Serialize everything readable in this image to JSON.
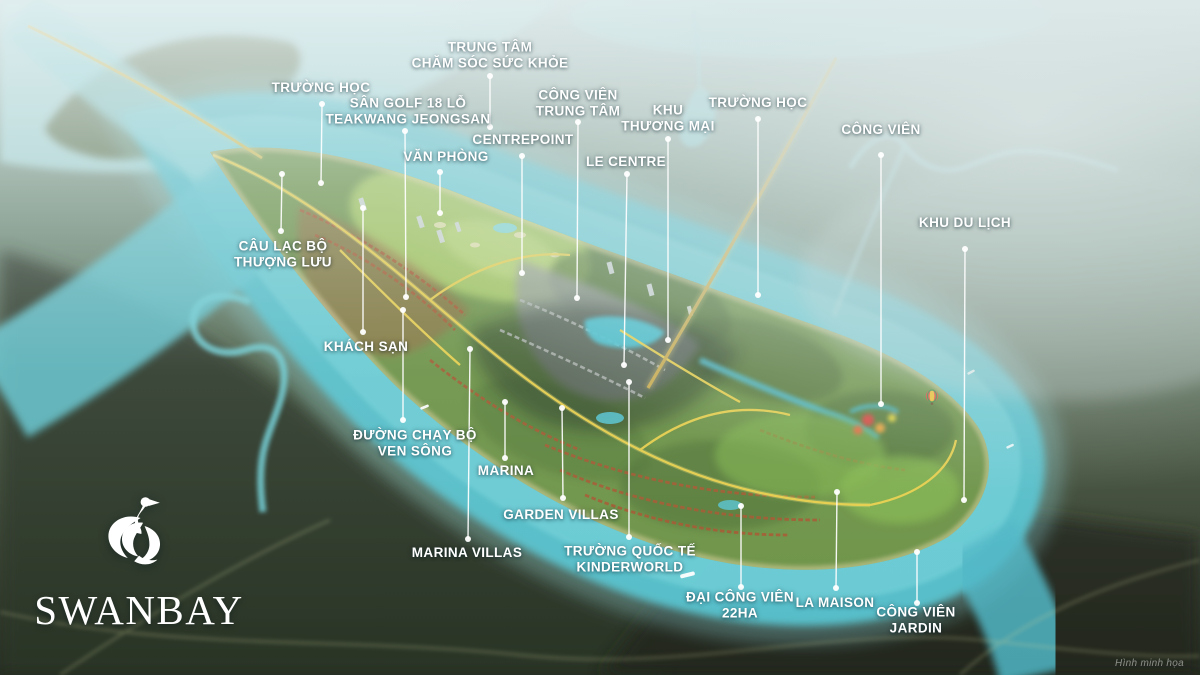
{
  "logo": {
    "brand": "SWANBAY"
  },
  "watermark": "Hình minh họa",
  "palette": {
    "river": "#5ec5d2",
    "river_light": "#9fe0e6",
    "island_green": "#6d9346",
    "road_yellow": "#ecd14b",
    "marsh_dark": "#2c3527",
    "label_text": "#ffffff"
  },
  "labels": [
    {
      "id": "school-west",
      "lines": [
        "TRƯỜNG HỌC"
      ],
      "x": 321,
      "y": 88,
      "dot": {
        "x": 322,
        "y": 104
      },
      "end": {
        "x": 321,
        "y": 183
      }
    },
    {
      "id": "health-center",
      "lines": [
        "TRUNG TÂM",
        "CHĂM SÓC SỨC KHỎE"
      ],
      "x": 490,
      "y": 56,
      "dot": {
        "x": 490,
        "y": 76
      },
      "end": {
        "x": 490,
        "y": 127
      }
    },
    {
      "id": "golf-course",
      "lines": [
        "SÂN GOLF 18 LỖ",
        "TEAKWANG JEONGSAN"
      ],
      "x": 408,
      "y": 112,
      "dot": {
        "x": 405,
        "y": 131
      },
      "end": {
        "x": 406,
        "y": 297
      }
    },
    {
      "id": "office",
      "lines": [
        "VĂN PHÒNG"
      ],
      "x": 446,
      "y": 157,
      "dot": {
        "x": 440,
        "y": 172
      },
      "end": {
        "x": 440,
        "y": 213
      }
    },
    {
      "id": "centrepoint",
      "lines": [
        "CENTREPOINT"
      ],
      "x": 523,
      "y": 140,
      "dot": {
        "x": 522,
        "y": 156
      },
      "end": {
        "x": 522,
        "y": 273
      }
    },
    {
      "id": "central-park",
      "lines": [
        "CÔNG VIÊN",
        "TRUNG TÂM"
      ],
      "x": 578,
      "y": 104,
      "dot": {
        "x": 578,
        "y": 122
      },
      "end": {
        "x": 577,
        "y": 298
      }
    },
    {
      "id": "commercial-area",
      "lines": [
        "KHU",
        "THƯƠNG MẠI"
      ],
      "x": 668,
      "y": 119,
      "dot": {
        "x": 668,
        "y": 139
      },
      "end": {
        "x": 668,
        "y": 340
      }
    },
    {
      "id": "school-east",
      "lines": [
        "TRƯỜNG HỌC"
      ],
      "x": 758,
      "y": 103,
      "dot": {
        "x": 758,
        "y": 119
      },
      "end": {
        "x": 758,
        "y": 295
      }
    },
    {
      "id": "le-centre",
      "lines": [
        "LE CENTRE"
      ],
      "x": 626,
      "y": 162,
      "dot": {
        "x": 627,
        "y": 174
      },
      "end": {
        "x": 624,
        "y": 365
      }
    },
    {
      "id": "park-north",
      "lines": [
        "CÔNG VIÊN"
      ],
      "x": 881,
      "y": 130,
      "dot": {
        "x": 881,
        "y": 155
      },
      "end": {
        "x": 881,
        "y": 404
      }
    },
    {
      "id": "tourism-area",
      "lines": [
        "KHU DU LỊCH"
      ],
      "x": 965,
      "y": 223,
      "dot": {
        "x": 965,
        "y": 249
      },
      "end": {
        "x": 964,
        "y": 500
      }
    },
    {
      "id": "upper-class-club",
      "lines": [
        "CÂU LẠC BỘ",
        "THƯỢNG LƯU"
      ],
      "x": 283,
      "y": 255,
      "dot": {
        "x": 281,
        "y": 231
      },
      "end": {
        "x": 282,
        "y": 174
      }
    },
    {
      "id": "hotel",
      "lines": [
        "KHÁCH SẠN"
      ],
      "x": 366,
      "y": 347,
      "dot": {
        "x": 363,
        "y": 332
      },
      "end": {
        "x": 363,
        "y": 208
      }
    },
    {
      "id": "riverside-jogging",
      "lines": [
        "ĐƯỜNG CHẠY BỘ",
        "VEN SÔNG"
      ],
      "x": 415,
      "y": 444,
      "dot": {
        "x": 403,
        "y": 420
      },
      "end": {
        "x": 403,
        "y": 310
      }
    },
    {
      "id": "marina",
      "lines": [
        "MARINA"
      ],
      "x": 506,
      "y": 471,
      "dot": {
        "x": 505,
        "y": 458
      },
      "end": {
        "x": 505,
        "y": 402
      }
    },
    {
      "id": "garden-villas",
      "lines": [
        "GARDEN VILLAS"
      ],
      "x": 561,
      "y": 515,
      "dot": {
        "x": 563,
        "y": 498
      },
      "end": {
        "x": 562,
        "y": 408
      }
    },
    {
      "id": "marina-villas",
      "lines": [
        "MARINA VILLAS"
      ],
      "x": 467,
      "y": 553,
      "dot": {
        "x": 468,
        "y": 539
      },
      "end": {
        "x": 470,
        "y": 349
      }
    },
    {
      "id": "kinderworld-school",
      "lines": [
        "TRƯỜNG QUỐC TẾ",
        "KINDERWORLD"
      ],
      "x": 630,
      "y": 560,
      "dot": {
        "x": 629,
        "y": 537
      },
      "end": {
        "x": 629,
        "y": 382
      }
    },
    {
      "id": "grand-park-22ha",
      "lines": [
        "ĐẠI CÔNG VIÊN",
        "22HA"
      ],
      "x": 740,
      "y": 606,
      "dot": {
        "x": 741,
        "y": 587
      },
      "end": {
        "x": 741,
        "y": 506
      }
    },
    {
      "id": "la-maison",
      "lines": [
        "LA MAISON"
      ],
      "x": 835,
      "y": 603,
      "dot": {
        "x": 836,
        "y": 588
      },
      "end": {
        "x": 837,
        "y": 492
      }
    },
    {
      "id": "jardin-park",
      "lines": [
        "CÔNG VIÊN",
        "JARDIN"
      ],
      "x": 916,
      "y": 621,
      "dot": {
        "x": 917,
        "y": 603
      },
      "end": {
        "x": 917,
        "y": 552
      }
    }
  ]
}
